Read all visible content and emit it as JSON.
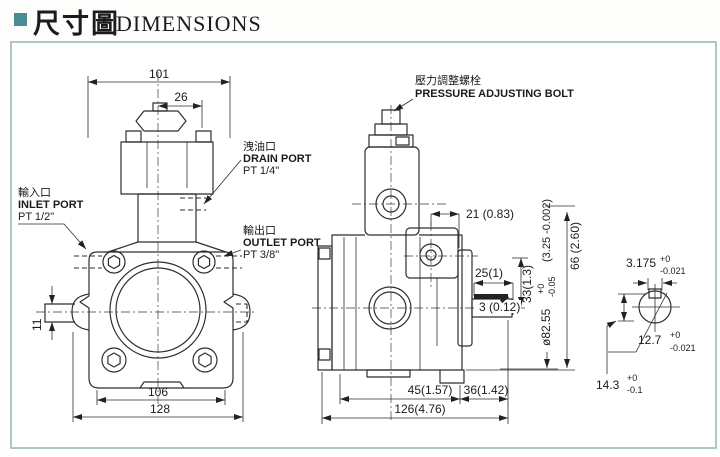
{
  "header": {
    "title_cjk": "尺寸圖",
    "title_en": "DIMENSIONS",
    "accent": "#4d8c94"
  },
  "front_view": {
    "dims": {
      "overall_top": "101",
      "adjuster": "26",
      "body": "106",
      "overall": "128",
      "shaft": "11"
    },
    "ports": {
      "inlet": {
        "cjk": "輸入口",
        "en": "INLET PORT",
        "thread": "PT 1/2\""
      },
      "drain": {
        "cjk": "洩油口",
        "en": "DRAIN PORT",
        "thread": "PT 1/4\""
      },
      "outlet": {
        "cjk": "輸出口",
        "en": "OUTLET PORT",
        "thread": "PT 3/8\""
      }
    }
  },
  "side_view": {
    "pressure_bolt": {
      "cjk": "壓力調整螺栓",
      "en": "PRESSURE ADJUSTING BOLT"
    },
    "dims": {
      "d21": "21  (0.83)",
      "d25": "25(1)",
      "d33": "33(1.3)",
      "d3": "3 (0.12)",
      "d66": "66 (2.60)",
      "pilot_dia": "ø82.55",
      "pilot_tol_plus": "+0",
      "pilot_tol_minus": "-0.05",
      "pilot_inch": "(3.25 -0.002)",
      "d45": "45(1.57)",
      "d36": "36(1.42)",
      "d126": "126(4.76)"
    }
  },
  "shaft_detail": {
    "key_width": {
      "value": "3.175",
      "tol_plus": "+0",
      "tol_minus": "-0.021"
    },
    "diameter": {
      "value": "12.7",
      "tol_plus": "+0",
      "tol_minus": "-0.021"
    },
    "height": {
      "value": "14.3",
      "tol_plus": "+0",
      "tol_minus": "-0.1"
    }
  }
}
